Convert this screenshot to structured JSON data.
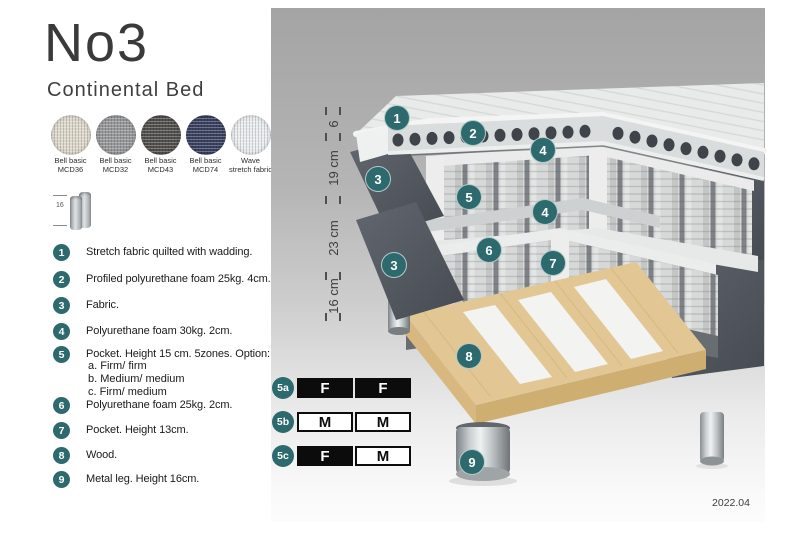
{
  "header": {
    "title": "No3",
    "subtitle": "Continental Bed"
  },
  "swatches": [
    {
      "line1": "Bell basic",
      "line2": "MCD36",
      "color": "#ddd8cb"
    },
    {
      "line1": "Bell basic",
      "line2": "MCD32",
      "color": "#97989a"
    },
    {
      "line1": "Bell basic",
      "line2": "MCD43",
      "color": "#52504d"
    },
    {
      "line1": "Bell basic",
      "line2": "MCD74",
      "color": "#3a4160"
    },
    {
      "line1": "Wave",
      "line2": "stretch fabric",
      "color": "#e9ecee"
    }
  ],
  "leg_icon": {
    "dimension": "16"
  },
  "legend": [
    {
      "num": "1",
      "text": "Stretch fabric quilted with wadding."
    },
    {
      "num": "2",
      "text": "Profiled polyurethane foam 25kg. 4cm."
    },
    {
      "num": "3",
      "text": "Fabric."
    },
    {
      "num": "4",
      "text": "Polyurethane foam 30kg. 2cm."
    },
    {
      "num": "5",
      "text": "Pocket. Height 15 cm. 5zones. Option:",
      "options": [
        "a. Firm/ firm",
        "b. Medium/ medium",
        "c. Firm/ medium"
      ]
    },
    {
      "num": "6",
      "text": "Polyurethane foam 25kg. 2cm."
    },
    {
      "num": "7",
      "text": "Pocket. Height 13cm."
    },
    {
      "num": "8",
      "text": "Wood."
    },
    {
      "num": "9",
      "text": "Metal leg. Height 16cm."
    }
  ],
  "diagram": {
    "dimensions": [
      "6",
      "19 cm",
      "23 cm",
      "16 cm"
    ],
    "callouts": [
      "1",
      "2",
      "3",
      "4",
      "5",
      "4",
      "3",
      "6",
      "7",
      "8",
      "9"
    ]
  },
  "firmness": {
    "rows": [
      {
        "label": "5a",
        "cells": [
          {
            "text": "F",
            "style": "dark"
          },
          {
            "text": "F",
            "style": "dark"
          }
        ]
      },
      {
        "label": "5b",
        "cells": [
          {
            "text": "M",
            "style": "light"
          },
          {
            "text": "M",
            "style": "light"
          }
        ]
      },
      {
        "label": "5c",
        "cells": [
          {
            "text": "F",
            "style": "dark"
          },
          {
            "text": "M",
            "style": "light"
          }
        ]
      }
    ]
  },
  "footer": {
    "date": "2022.04"
  },
  "colors": {
    "accent_teal": "#2d6a6e",
    "fabric_dark": "#575c64",
    "wood": "#e2c795",
    "panel_gray": "#a4a4a4"
  }
}
